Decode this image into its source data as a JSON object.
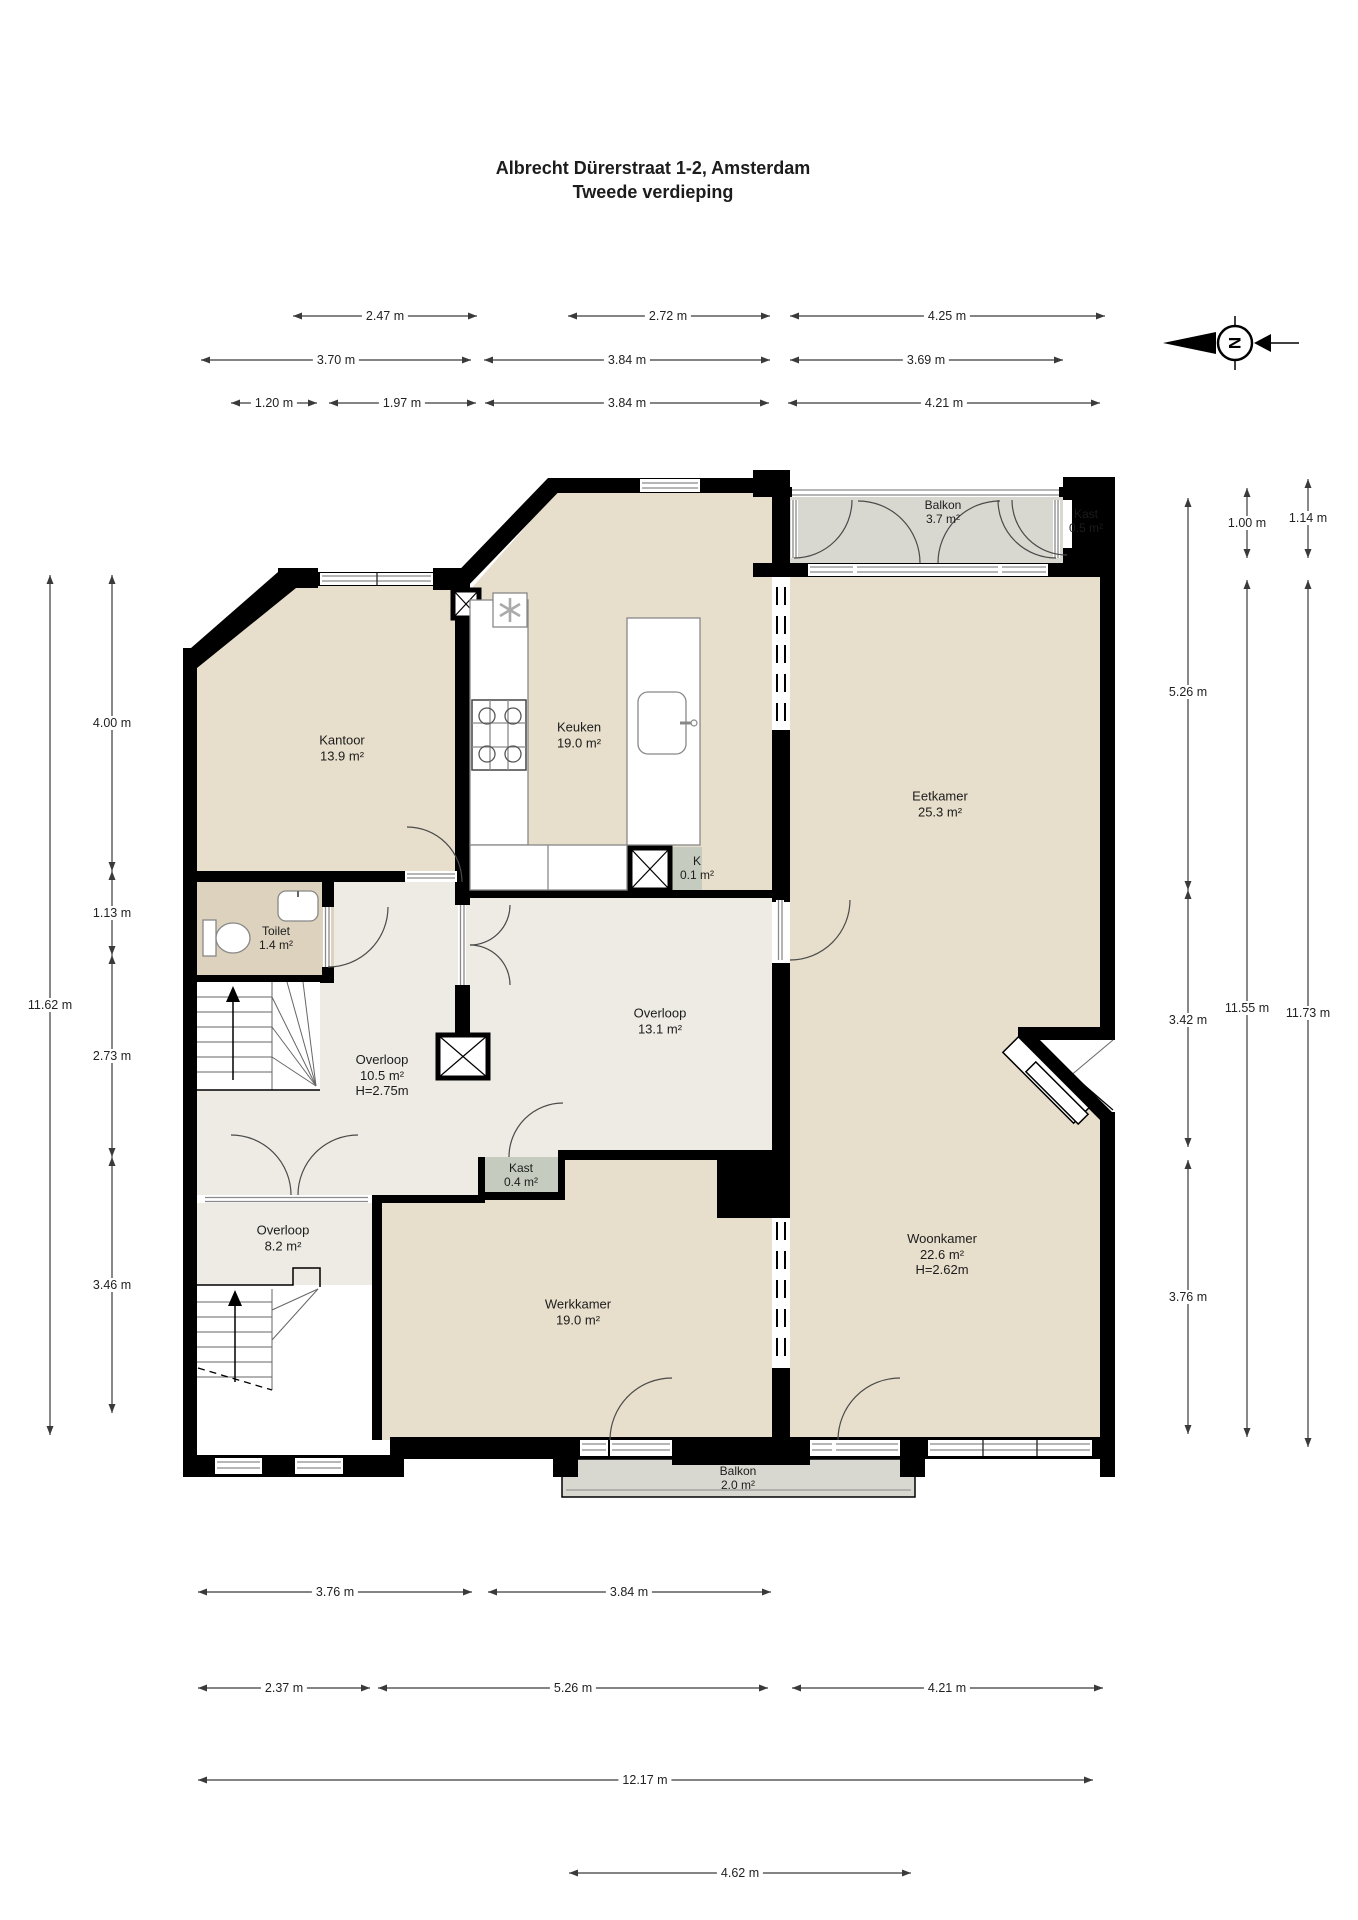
{
  "title": {
    "line1": "Albrecht Dürerstraat 1-2, Amsterdam",
    "line2": "Tweede verdieping"
  },
  "compass": {
    "north_letter": "N"
  },
  "colors": {
    "wall": "#000000",
    "room_floor": "#e7decb",
    "hall_floor": "#edebe4",
    "toilet_floor": "#dcd2be",
    "balcony_floor": "#d9d8d0",
    "closet_floor": "#c6cbc0",
    "dimension": "#3a3a3a",
    "window_frame": "#8a8a8a"
  },
  "rooms": [
    {
      "name": "Kantoor",
      "area": "13.9 m²"
    },
    {
      "name": "Keuken",
      "area": "19.0 m²"
    },
    {
      "name": "Eetkamer",
      "area": "25.3 m²"
    },
    {
      "name": "Balkon",
      "area": "3.7 m²"
    },
    {
      "name": "Kast",
      "area": "0.5 m²"
    },
    {
      "name": "K",
      "area": "0.1 m²"
    },
    {
      "name": "Toilet",
      "area": "1.4 m²"
    },
    {
      "name": "Overloop",
      "area": "13.1 m²"
    },
    {
      "name": "Overloop",
      "area": "10.5 m²",
      "height": "H=2.75m"
    },
    {
      "name": "Kast",
      "area": "0.4 m²"
    },
    {
      "name": "Overloop",
      "area": "8.2 m²"
    },
    {
      "name": "Werkkamer",
      "area": "19.0 m²"
    },
    {
      "name": "Woonkamer",
      "area": "22.6 m²",
      "height": "H=2.62m"
    },
    {
      "name": "Balkon",
      "area": "2.0 m²"
    }
  ],
  "dimensions": {
    "top_row1": [
      "2.47 m",
      "2.72 m",
      "4.25 m"
    ],
    "top_row2": [
      "3.70 m",
      "3.84 m",
      "3.69 m"
    ],
    "top_row3": [
      "1.20 m",
      "1.97 m",
      "3.84 m",
      "4.21 m"
    ],
    "left_total": "11.62 m",
    "left_segments": [
      "4.00 m",
      "1.13 m",
      "2.73 m",
      "3.46 m"
    ],
    "right_col1": [
      "5.26 m",
      "3.42 m",
      "3.76 m"
    ],
    "right_col2": [
      "1.00 m",
      "11.55 m"
    ],
    "right_col3": [
      "1.14 m",
      "11.73 m"
    ],
    "bottom_row1": [
      "3.76 m",
      "3.84 m"
    ],
    "bottom_row2": [
      "2.37 m",
      "5.26 m",
      "4.21 m"
    ],
    "bottom_row3": [
      "12.17 m"
    ],
    "bottom_row4": [
      "4.62 m"
    ]
  }
}
